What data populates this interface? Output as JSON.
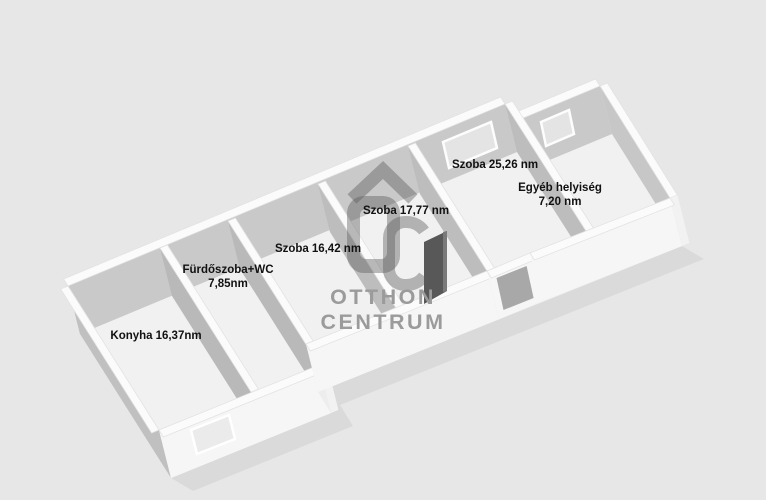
{
  "scene": {
    "type": "3d-floor-plan",
    "background_color": "#e7e7e7",
    "unit": "nm"
  },
  "rooms": [
    {
      "id": "konyha",
      "name": "Konyha",
      "area": "16,37nm",
      "layout": "inline"
    },
    {
      "id": "furdoszoba-wc",
      "name": "Fürdőszoba+WC",
      "area": "7,85nm",
      "layout": "stacked"
    },
    {
      "id": "szoba-1",
      "name": "Szoba",
      "area": "16,42 nm",
      "layout": "inline"
    },
    {
      "id": "szoba-2",
      "name": "Szoba",
      "area": "17,77 nm",
      "layout": "inline"
    },
    {
      "id": "szoba-3",
      "name": "Szoba",
      "area": "25,26 nm",
      "layout": "inline"
    },
    {
      "id": "egyeb-helyiseg",
      "name": "Egyéb helyiség",
      "area": "7,20 nm",
      "layout": "stacked"
    }
  ],
  "watermark": {
    "brand_line1": "OTTHON",
    "brand_line2": "CENTRUM",
    "logo": "otthon-centrum-oc-roof-logo",
    "color": "#9b9b9b"
  },
  "colors": {
    "background": "#e7e7e7",
    "floor": "#f1f1f1",
    "wall_exterior": "#f6f6f6",
    "wall_cap": "#fbfbfb",
    "wall_shadow_back": "#c9c9c9",
    "wall_shadow_side": "#b9b9b9",
    "window_glass": "#e4e4e4",
    "open_door": "#585858",
    "label_text": "#111111",
    "watermark": "#9b9b9b"
  }
}
